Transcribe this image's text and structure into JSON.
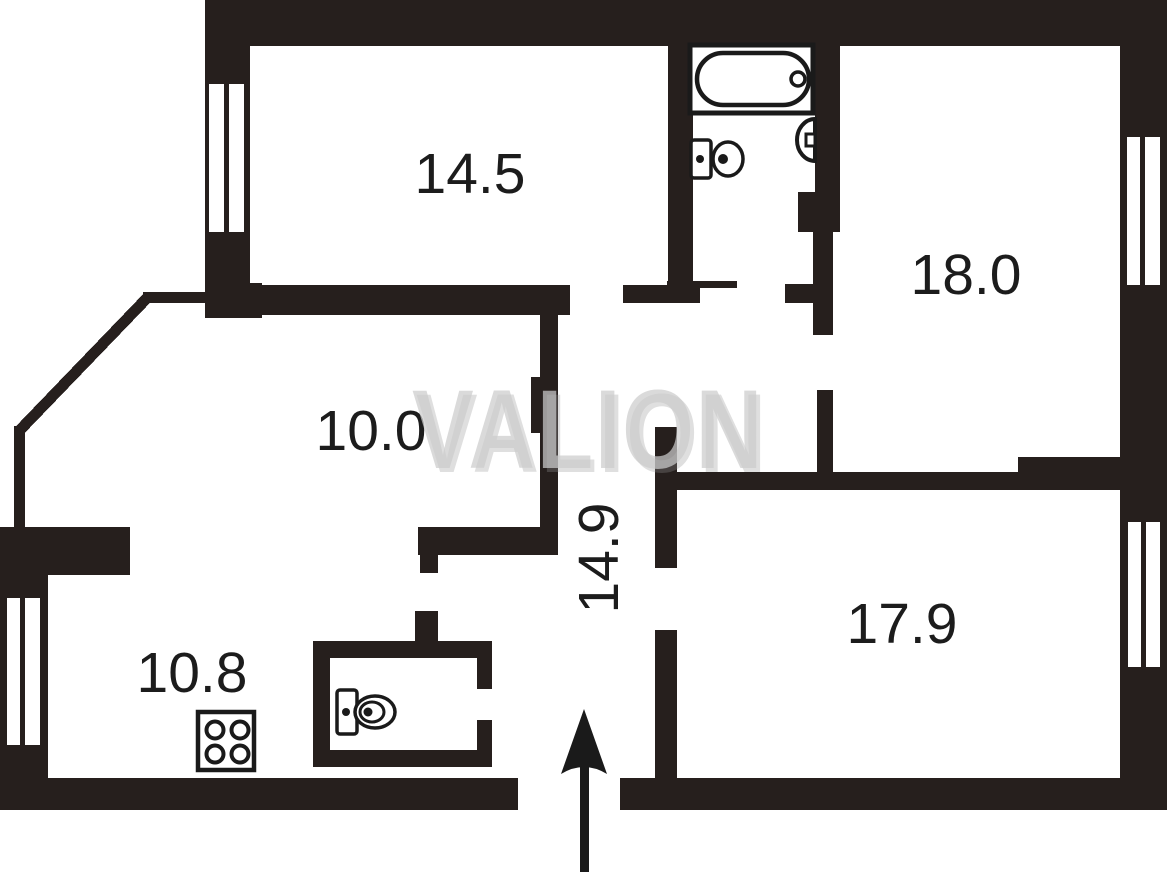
{
  "plan": {
    "title": "apartment-floor-plan",
    "watermark": {
      "text": "VALION"
    },
    "rooms": {
      "top_left_room": {
        "area": "14.5"
      },
      "top_right_room": {
        "area": "18.0"
      },
      "middle_room": {
        "area": "10.0"
      },
      "hallway": {
        "area": "14.9"
      },
      "bottom_right_room": {
        "area": "17.9"
      },
      "kitchen": {
        "area": "10.8"
      }
    },
    "icons": {
      "bathtub": "bathtub-icon",
      "bathroom_sink": "sink-icon",
      "bathroom_toilet": "toilet-icon",
      "wc_toilet": "toilet-icon",
      "stove": "stove-icon",
      "entrance_arrow": "entrance-arrow-icon",
      "windows": "window-icon"
    },
    "colors": {
      "wall": "#261f1d",
      "line": "#1a1a1a",
      "label": "#1c1c1c",
      "background": "#ffffff",
      "watermark_fill": "rgba(204,204,204,0.72)",
      "watermark_shadow": "rgba(150,150,150,0.30)"
    }
  }
}
